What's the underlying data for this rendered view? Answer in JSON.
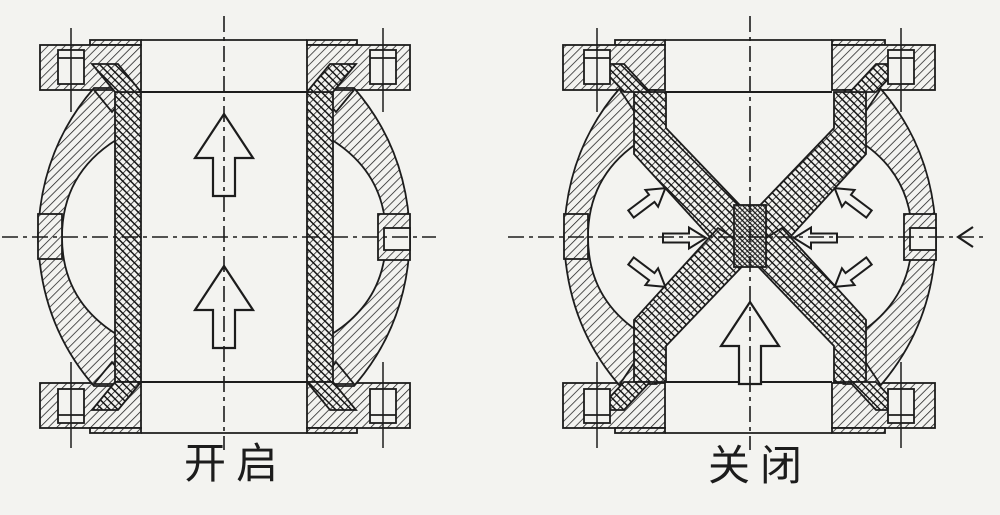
{
  "diagram": {
    "background_color": "#f3f3f0",
    "line_color": "#1c1c1c",
    "views": [
      {
        "label": "开启",
        "state": "open",
        "icons": [
          "flow-up-arrow",
          "flow-up-arrow"
        ]
      },
      {
        "label": "关闭",
        "state": "closed",
        "icons": [
          "pinch-pressure-arrow",
          "pinch-pressure-arrow",
          "pinch-pressure-arrow",
          "pinch-pressure-arrow",
          "pinch-pressure-arrow",
          "pinch-pressure-arrow",
          "blocked-flow-up-arrow",
          "air-inlet-chevron"
        ]
      }
    ]
  }
}
